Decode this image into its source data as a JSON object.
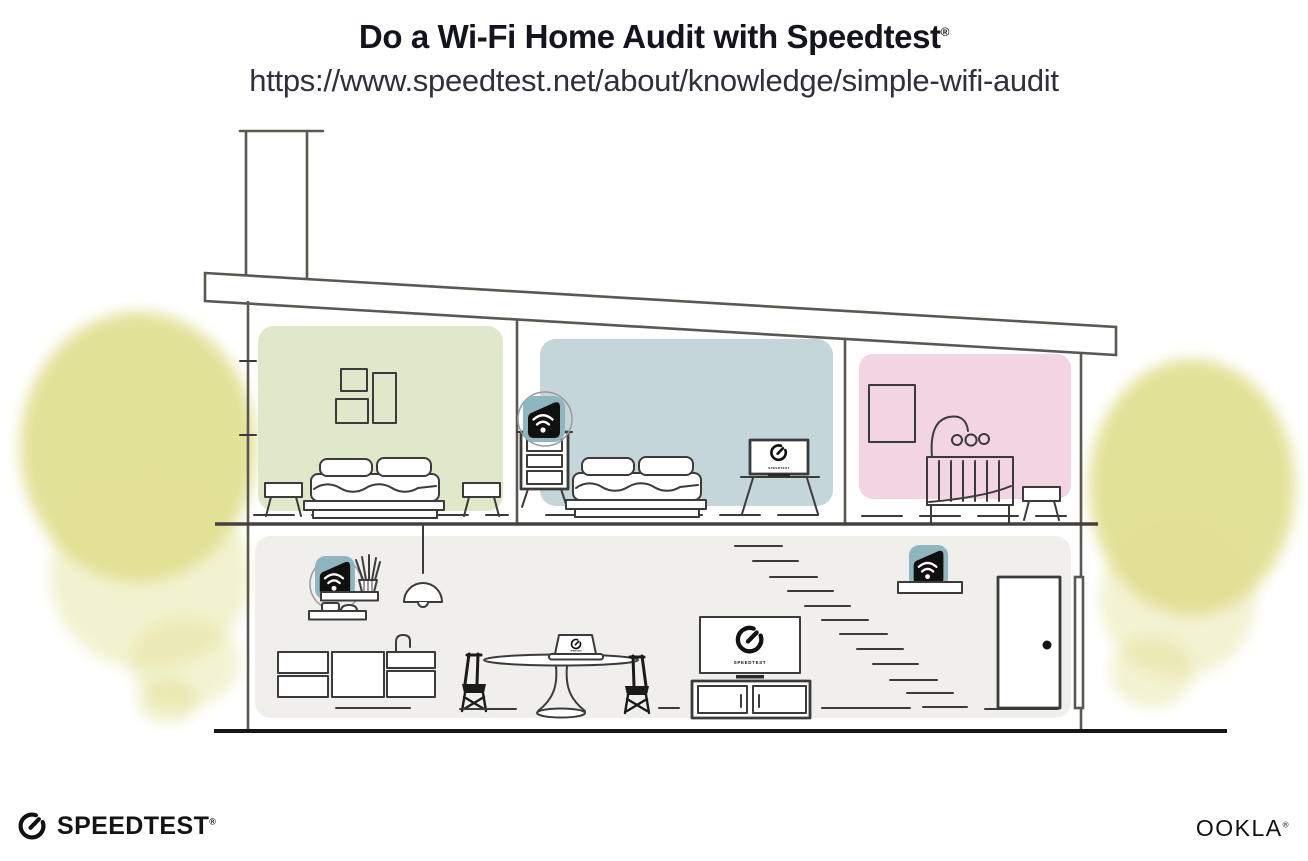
{
  "header": {
    "title": "Do a Wi-Fi Home Audit with Speedtest",
    "title_mark": "®",
    "url": "https://www.speedtest.net/about/knowledge/simple-wifi-audit"
  },
  "illustration": {
    "description": "Cross-section of a two-story house: Wi-Fi router on a kitchen shelf and extenders on a bedroom dresser and a stair shelf; Speedtest gauge shown on a bedroom TV, a living-room TV and a laptop; yellow watercolor trees on both sides",
    "screens": {
      "bedroom_tv_label": "SPEEDTEST",
      "living_tv_label": "SPEEDTEST",
      "laptop_label": "SPEEDTEST"
    },
    "colors": {
      "room_green": "#dfe8c9",
      "room_blue": "#c5d6da",
      "room_pink": "#f3d4e3",
      "ground_floor": "#f0efeb",
      "tree_yellow": "#e0df8e",
      "device_teal": "#8fb6bf"
    }
  },
  "footer": {
    "speedtest_wordmark": "SPEEDTEST",
    "speedtest_mark": "®",
    "ookla_wordmark": "OOKLA",
    "ookla_mark": "®"
  }
}
